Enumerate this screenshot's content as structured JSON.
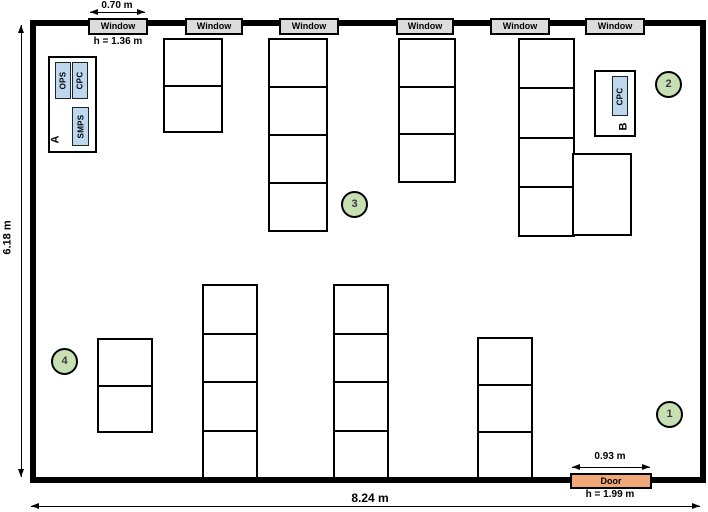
{
  "diagram_title": "room-floor-plan",
  "dimensions": {
    "room_width": "8.24 m",
    "room_height": "6.18 m",
    "window_width": "0.70 m",
    "window_height": "h = 1.36 m",
    "door_width": "0.93 m",
    "door_height": "h = 1.99 m"
  },
  "window_label": "Window",
  "door_label": "Door",
  "stations": {
    "a": {
      "label": "A",
      "devices": [
        "OPS",
        "CPC",
        "SMPS"
      ]
    },
    "b": {
      "label": "B",
      "devices": [
        "CPC"
      ]
    }
  },
  "markers": [
    "1",
    "2",
    "3",
    "4"
  ],
  "colors": {
    "wall": "#000000",
    "window_fill": "#dcdcdc",
    "door_fill": "#f0a878",
    "marker_fill": "#c6e0b4",
    "device_fill": "#bdd7ee"
  }
}
